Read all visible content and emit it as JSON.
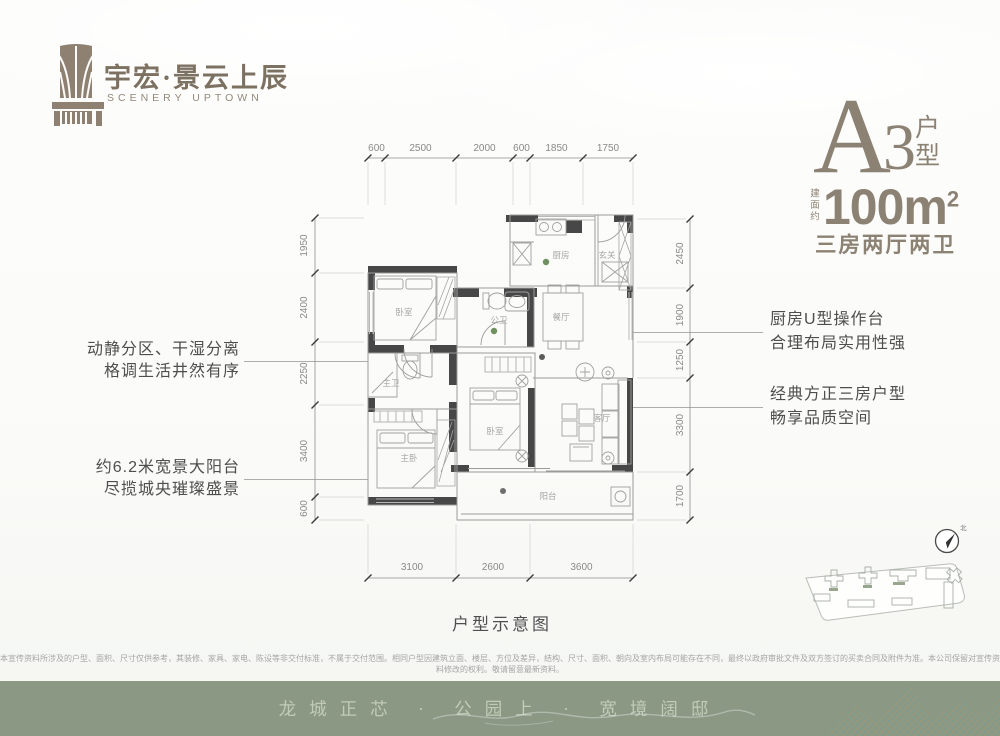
{
  "header": {
    "logo_cn": "宇宏·景云上辰",
    "logo_en": "SCENERY UPTOWN"
  },
  "unit": {
    "letter": "A",
    "number": "3",
    "type_char_1": "户",
    "type_char_2": "型",
    "area_prefix": "建面约",
    "area": "100m",
    "area_sup": "2",
    "rooms_line": "三房两厅两卫"
  },
  "annotations": {
    "left": [
      {
        "line1": "动静分区、干湿分离",
        "line2": "格调生活井然有序"
      },
      {
        "line1": "约6.2米宽景大阳台",
        "line2": "尽揽城央璀璨盛景"
      }
    ],
    "right": [
      {
        "line1": "厨房U型操作台",
        "line2": "合理布局实用性强"
      },
      {
        "line1": "经典方正三房户型",
        "line2": "畅享品质空间"
      }
    ]
  },
  "floor_plan": {
    "caption": "户型示意图",
    "rooms": [
      "卧室",
      "厨房",
      "玄关",
      "公卫",
      "餐厅",
      "主卫",
      "主卧",
      "卧室",
      "客厅",
      "阳台"
    ],
    "dimensions": {
      "top": [
        "600",
        "2500",
        "2000",
        "600",
        "1850",
        "1750"
      ],
      "left": [
        "1950",
        "2400",
        "2250",
        "3400",
        "600"
      ],
      "right": [
        "2450",
        "1900",
        "1250",
        "3300",
        "1700"
      ],
      "bottom": [
        "3100",
        "2600",
        "3600"
      ]
    }
  },
  "compass": {
    "north_label": "北"
  },
  "disclaimer": "本宣传资料所涉及的户型、面积、尺寸仅供参考，其装修、家具、家电、陈设等非交付标准，不属于交付范围。相同户型因建筑立面、楼层、方位及差异，结构、尺寸、面积、朝向及室内布局可能存在不同，最终以政府审批文件及双方签订的买卖合同及附件为准。本公司保留对宣传资料修改的权利。敬请留意最新资料。",
  "footer": {
    "slogan": "龙城正芯 · 公园上 · 宽境阔邸"
  },
  "colors": {
    "accent_taupe": "#8c8273",
    "wall_dark": "#474747",
    "band_green": "#8a9884",
    "green_dot": "#6f9160"
  }
}
